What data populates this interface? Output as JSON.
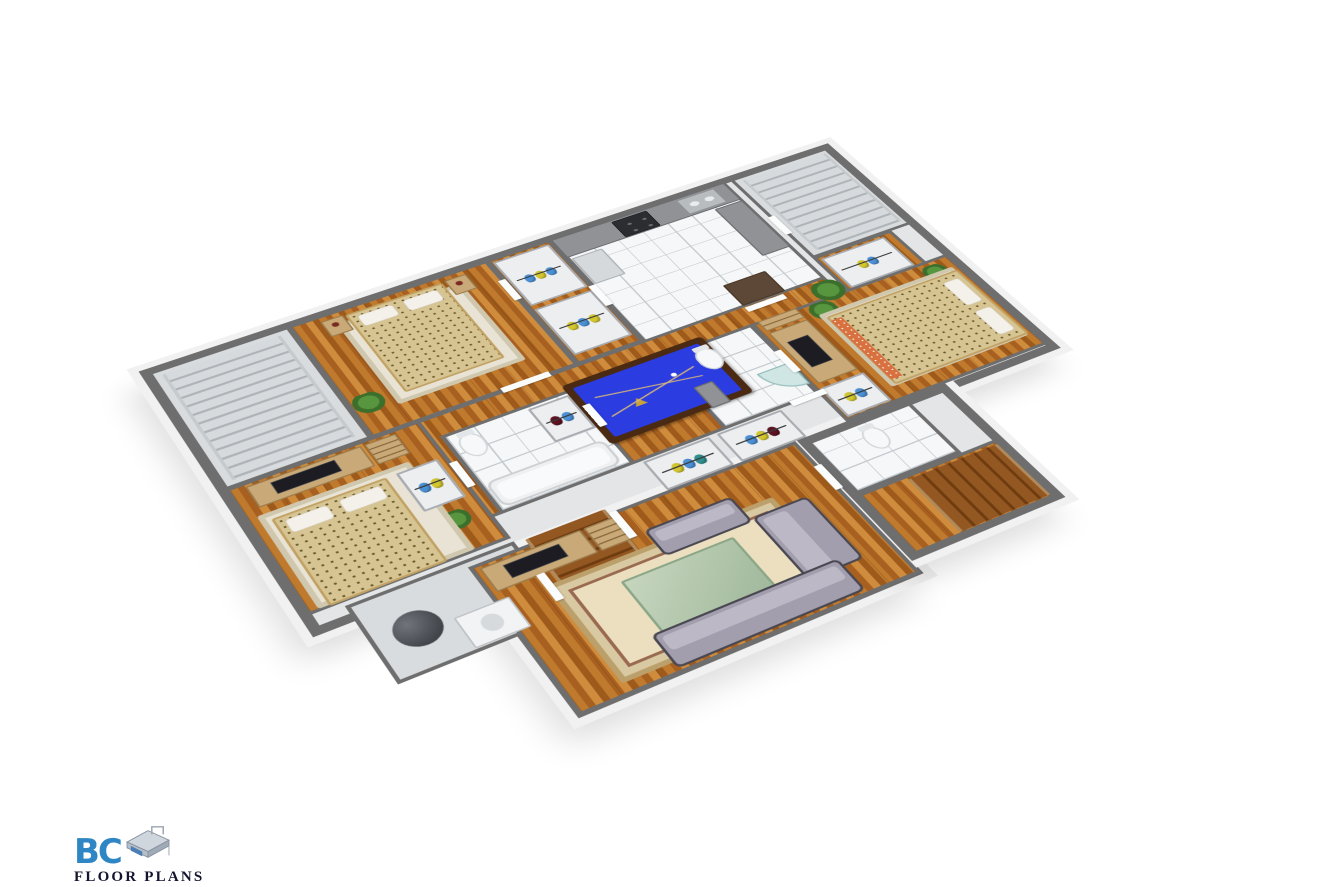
{
  "page": {
    "background": "#ffffff",
    "kind": "3d-floor-plan-render"
  },
  "logo": {
    "brand": "BC",
    "subtitle": "FLOOR PLANS",
    "brand_color": "#2f86c4",
    "subtitle_color": "#14142e"
  },
  "palette": {
    "wall_top": "#6e6e6e",
    "slab_edge": "#f1f1f1",
    "wood_floor": "#b06a22",
    "tile_floor": "#f5f7f8",
    "carpet": "#d9dcde",
    "pool_felt": "#2b3ce0",
    "sofa": "#a29eae",
    "bed_spread": "#d6c493",
    "clothes_blue": "#4a8fd4",
    "clothes_yellow": "#d2c62e",
    "stairs_wood": "#8a4f1f"
  },
  "scene": {
    "description": "Isometric 3D floor plan of a single storey with games room, kitchen, three bedrooms, bathrooms, closets and staircases",
    "rooms_visible": [
      "staircase hall",
      "master bedroom",
      "walk-in closets",
      "kitchen",
      "upper staircase",
      "games room with pool table",
      "bedroom 2",
      "family bathroom",
      "hall closets",
      "utility room",
      "basement stairs",
      "living room",
      "bedroom 3",
      "ensuite bathroom",
      "entry bathroom",
      "entry stairs"
    ]
  },
  "plan": {
    "width": 1000,
    "height": 780,
    "slabs": [
      {
        "name": "building-main-slab",
        "x": 10,
        "y": 10,
        "w": 978,
        "h": 512
      },
      {
        "name": "building-living-slab",
        "x": 196,
        "y": 508,
        "w": 424,
        "h": 254
      },
      {
        "name": "building-entry-slab",
        "x": 620,
        "y": 508,
        "w": 208,
        "h": 232
      }
    ],
    "rooms": [
      {
        "name": "stair-hall",
        "x": 18,
        "y": 18,
        "w": 182,
        "h": 242,
        "floor": "concrete"
      },
      {
        "name": "master-bedroom",
        "x": 198,
        "y": 18,
        "w": 272,
        "h": 242,
        "floor": "wood"
      },
      {
        "name": "master-closets",
        "x": 468,
        "y": 18,
        "w": 92,
        "h": 242,
        "floor": "wood"
      },
      {
        "name": "kitchen",
        "x": 558,
        "y": 18,
        "w": 262,
        "h": 252,
        "floor": "tile"
      },
      {
        "name": "upper-stairs-landing",
        "x": 828,
        "y": 18,
        "w": 152,
        "h": 202,
        "floor": "concrete"
      },
      {
        "name": "closet-top-right-room",
        "x": 828,
        "y": 218,
        "w": 120,
        "h": 86,
        "floor": "wood"
      },
      {
        "name": "games-room",
        "x": 198,
        "y": 258,
        "w": 622,
        "h": 192,
        "floor": "wood"
      },
      {
        "name": "bedroom-left",
        "x": 18,
        "y": 258,
        "w": 242,
        "h": 232,
        "floor": "wood"
      },
      {
        "name": "family-bathroom",
        "x": 268,
        "y": 296,
        "w": 172,
        "h": 154,
        "floor": "tile"
      },
      {
        "name": "ensuite-bathroom",
        "x": 558,
        "y": 296,
        "w": 132,
        "h": 154,
        "floor": "tile"
      },
      {
        "name": "bedroom-right",
        "x": 688,
        "y": 296,
        "w": 292,
        "h": 212,
        "floor": "wood"
      },
      {
        "name": "utility-room",
        "x": 58,
        "y": 496,
        "w": 202,
        "h": 132,
        "floor": "concrete"
      },
      {
        "name": "living-room",
        "x": 198,
        "y": 508,
        "w": 420,
        "h": 252,
        "floor": "wood"
      },
      {
        "name": "entry-bathroom",
        "x": 628,
        "y": 516,
        "w": 144,
        "h": 104,
        "floor": "tile"
      },
      {
        "name": "entry-hall",
        "x": 628,
        "y": 620,
        "w": 192,
        "h": 114,
        "floor": "wood"
      }
    ],
    "items": [
      {
        "name": "staircase-upper-left",
        "type": "stairs",
        "cls": "sg",
        "x": 32,
        "y": 30,
        "w": 152,
        "h": 218
      },
      {
        "name": "rug-master",
        "type": "rug",
        "cls": "light",
        "x": 252,
        "y": 44,
        "w": 168,
        "h": 176
      },
      {
        "name": "nightstand-left",
        "type": "nightstand",
        "x": 236,
        "y": 30,
        "w": 30,
        "h": 34
      },
      {
        "name": "nightstand-right",
        "type": "nightstand",
        "x": 404,
        "y": 30,
        "w": 30,
        "h": 34
      },
      {
        "name": "bed-master",
        "type": "bed",
        "pillows": "top",
        "x": 268,
        "y": 32,
        "w": 132,
        "h": 172
      },
      {
        "name": "plant-master",
        "type": "plant",
        "x": 204,
        "y": 182,
        "w": 38,
        "h": 38
      },
      {
        "name": "closet-master-1",
        "type": "closet",
        "clothes": [
          "blue",
          "yellow",
          "blue"
        ],
        "x": 474,
        "y": 26,
        "w": 80,
        "h": 104
      },
      {
        "name": "closet-master-2",
        "type": "closet",
        "clothes": [
          "yellow",
          "blue",
          "yellow"
        ],
        "x": 474,
        "y": 138,
        "w": 80,
        "h": 104
      },
      {
        "name": "kitchen-counter-top",
        "type": "counter",
        "x": 560,
        "y": 20,
        "w": 258,
        "h": 44
      },
      {
        "name": "stove",
        "type": "stove",
        "x": 646,
        "y": 24,
        "w": 52,
        "h": 38
      },
      {
        "name": "double-sink",
        "type": "sink",
        "x": 742,
        "y": 24,
        "w": 58,
        "h": 36
      },
      {
        "name": "fridge",
        "type": "fridge",
        "x": 564,
        "y": 68,
        "w": 44,
        "h": 62
      },
      {
        "name": "kitchen-counter-right",
        "type": "counter",
        "x": 776,
        "y": 66,
        "w": 42,
        "h": 118
      },
      {
        "name": "kitchen-island",
        "type": "island",
        "x": 700,
        "y": 212,
        "w": 62,
        "h": 48
      },
      {
        "name": "staircase-upper-right",
        "type": "stairs",
        "cls": "sg",
        "x": 842,
        "y": 28,
        "w": 130,
        "h": 180
      },
      {
        "name": "closet-top-right",
        "type": "closet",
        "clothes": [
          "yellow",
          "blue"
        ],
        "x": 836,
        "y": 226,
        "w": 96,
        "h": 70
      },
      {
        "name": "plant-games-1",
        "type": "plant",
        "x": 788,
        "y": 266,
        "w": 42,
        "h": 42
      },
      {
        "name": "pool-table",
        "type": "pool",
        "x": 432,
        "y": 286,
        "w": 192,
        "h": 122
      },
      {
        "name": "plant-games-2",
        "type": "plant",
        "x": 206,
        "y": 418,
        "w": 32,
        "h": 32
      },
      {
        "name": "tv-unit-bedroom-left",
        "type": "tvunit",
        "x": 40,
        "y": 266,
        "w": 142,
        "h": 40
      },
      {
        "name": "bookshelf-bedroom-left",
        "type": "shelf",
        "x": 186,
        "y": 266,
        "w": 40,
        "h": 40
      },
      {
        "name": "rug-bedroom-left",
        "type": "rug",
        "cls": "light",
        "x": 32,
        "y": 318,
        "w": 186,
        "h": 168
      },
      {
        "name": "bed-bedroom-left",
        "type": "bed",
        "pillows": "top",
        "x": 44,
        "y": 330,
        "w": 140,
        "h": 158
      },
      {
        "name": "closet-bedroom-left",
        "type": "closet",
        "clothes": [
          "blue",
          "yellow"
        ],
        "x": 196,
        "y": 330,
        "w": 52,
        "h": 74
      },
      {
        "name": "toilet-family-bath",
        "type": "toilet",
        "x": 280,
        "y": 308,
        "w": 30,
        "h": 42
      },
      {
        "name": "closet-family-bath",
        "type": "closet",
        "clothes": [
          "red",
          "blue"
        ],
        "x": 378,
        "y": 304,
        "w": 54,
        "h": 68
      },
      {
        "name": "bathtub-family-bath",
        "type": "tub",
        "x": 276,
        "y": 394,
        "w": 152,
        "h": 48
      },
      {
        "name": "hall-closet-1",
        "type": "closet",
        "clothes": [
          "yellow",
          "blue",
          "teal"
        ],
        "x": 448,
        "y": 452,
        "w": 88,
        "h": 56
      },
      {
        "name": "hall-closet-2",
        "type": "closet",
        "clothes": [
          "blue",
          "yellow",
          "red"
        ],
        "x": 546,
        "y": 452,
        "w": 88,
        "h": 56
      },
      {
        "name": "water-heater",
        "type": "heater",
        "x": 84,
        "y": 538,
        "w": 54,
        "h": 54
      },
      {
        "name": "washer",
        "type": "washer",
        "x": 150,
        "y": 570,
        "w": 66,
        "h": 52
      },
      {
        "name": "staircase-basement",
        "type": "stairs",
        "cls": "sw",
        "x": 272,
        "y": 500,
        "w": 100,
        "h": 144
      },
      {
        "name": "tv-unit-living",
        "type": "tvunit",
        "x": 208,
        "y": 516,
        "w": 124,
        "h": 42
      },
      {
        "name": "bookshelf-living",
        "type": "shelf",
        "x": 336,
        "y": 516,
        "w": 44,
        "h": 42
      },
      {
        "name": "rug-living",
        "type": "rug",
        "x": 258,
        "y": 576,
        "w": 286,
        "h": 166
      },
      {
        "name": "coffee-table-living",
        "type": "table",
        "x": 330,
        "y": 610,
        "w": 142,
        "h": 102
      },
      {
        "name": "armchair-living",
        "type": "sofa",
        "x": 392,
        "y": 552,
        "w": 112,
        "h": 48
      },
      {
        "name": "loveseat-living",
        "type": "sofa",
        "cls": "v",
        "x": 506,
        "y": 594,
        "w": 72,
        "h": 116
      },
      {
        "name": "sofa-living",
        "type": "sofa",
        "x": 318,
        "y": 696,
        "w": 234,
        "h": 56
      },
      {
        "name": "toilet-ensuite",
        "type": "toilet",
        "x": 596,
        "y": 308,
        "w": 30,
        "h": 42
      },
      {
        "name": "shower-ensuite",
        "type": "shower",
        "x": 644,
        "y": 382,
        "w": 46,
        "h": 46
      },
      {
        "name": "vanity-ensuite",
        "type": "counter",
        "x": 566,
        "y": 366,
        "w": 26,
        "h": 44
      },
      {
        "name": "shelf-bedroom-right",
        "type": "shelf",
        "x": 698,
        "y": 296,
        "w": 56,
        "h": 22
      },
      {
        "name": "tv-unit-bedroom-right",
        "type": "tvunit",
        "cls": "v",
        "x": 698,
        "y": 322,
        "w": 56,
        "h": 112
      },
      {
        "name": "plant-bedroom-right-1",
        "type": "plant",
        "x": 764,
        "y": 300,
        "w": 36,
        "h": 36
      },
      {
        "name": "plant-bedroom-right-2",
        "type": "plant",
        "x": 930,
        "y": 306,
        "w": 32,
        "h": 32
      },
      {
        "name": "rug-bedroom-right",
        "type": "rug",
        "cls": "light",
        "x": 770,
        "y": 322,
        "w": 200,
        "h": 160
      },
      {
        "name": "bed-bedroom-right",
        "type": "bed",
        "pillows": "right",
        "bench": true,
        "x": 776,
        "y": 330,
        "w": 196,
        "h": 150
      },
      {
        "name": "closet-bedroom-right",
        "type": "closet",
        "clothes": [
          "yellow",
          "blue"
        ],
        "x": 694,
        "y": 442,
        "w": 62,
        "h": 60
      },
      {
        "name": "toilet-entry-bath",
        "type": "toilet",
        "x": 688,
        "y": 530,
        "w": 28,
        "h": 40
      },
      {
        "name": "staircase-entry",
        "type": "stairs",
        "cls": "sh sw",
        "x": 692,
        "y": 628,
        "w": 124,
        "h": 100
      },
      {
        "name": "door-1",
        "type": "door",
        "x": 462,
        "y": 64,
        "w": 10,
        "h": 46
      },
      {
        "name": "door-2",
        "type": "door",
        "x": 554,
        "y": 130,
        "w": 10,
        "h": 46
      },
      {
        "name": "door-3",
        "type": "door",
        "x": 368,
        "y": 253,
        "w": 64,
        "h": 10
      },
      {
        "name": "door-4",
        "type": "door",
        "x": 700,
        "y": 264,
        "w": 56,
        "h": 10
      },
      {
        "name": "door-5",
        "type": "door",
        "x": 256,
        "y": 344,
        "w": 10,
        "h": 48
      },
      {
        "name": "door-6",
        "type": "door",
        "x": 436,
        "y": 330,
        "w": 10,
        "h": 44
      },
      {
        "name": "door-7",
        "type": "door",
        "x": 684,
        "y": 356,
        "w": 10,
        "h": 46
      },
      {
        "name": "door-8",
        "type": "door",
        "x": 650,
        "y": 444,
        "w": 48,
        "h": 10
      },
      {
        "name": "door-9",
        "type": "door",
        "x": 612,
        "y": 556,
        "w": 10,
        "h": 46
      },
      {
        "name": "door-10",
        "type": "door",
        "x": 256,
        "y": 556,
        "w": 10,
        "h": 46
      },
      {
        "name": "door-11",
        "type": "door",
        "x": 826,
        "y": 116,
        "w": 10,
        "h": 44
      },
      {
        "name": "door-12",
        "type": "door",
        "x": 372,
        "y": 508,
        "w": 10,
        "h": 48
      }
    ]
  }
}
